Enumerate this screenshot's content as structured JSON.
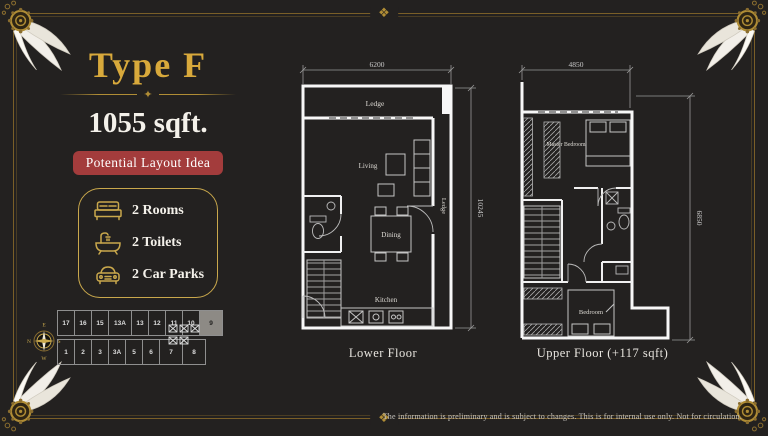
{
  "page": {
    "title": "Type F",
    "size": "1055 sqft.",
    "badge": "Potential Layout Idea"
  },
  "ornaments": {
    "divider_glyph": "✦",
    "frame_glyph": "❖"
  },
  "features": [
    {
      "icon": "bed-icon",
      "label": "2 Rooms"
    },
    {
      "icon": "bathtub-icon",
      "label": "2 Toilets"
    },
    {
      "icon": "car-icon",
      "label": "2 Car Parks"
    }
  ],
  "site_plan": {
    "units_top": [
      "17",
      "16",
      "15",
      "13A",
      "13",
      "12",
      "11",
      "10",
      "9"
    ],
    "units_bottom": [
      "1",
      "2",
      "3",
      "3A",
      "5",
      "6",
      "7",
      "8"
    ],
    "highlighted_unit": "9",
    "compass": {
      "top": "E",
      "right": "S",
      "bottom": "W",
      "left": "N"
    }
  },
  "lower_floor": {
    "label": "Lower Floor",
    "width_dim": "6200",
    "height_dim": "10245",
    "rooms": {
      "ledge_top": "Ledge",
      "living": "Living",
      "dining": "Dining",
      "kitchen": "Kitchen",
      "ledge_right": "Ledge"
    }
  },
  "upper_floor": {
    "label": "Upper Floor (+117 sqft)",
    "width_dim": "4850",
    "height_dim": "6850",
    "rooms": {
      "master_bedroom": "Master Bedroom",
      "bedroom": "Bedroom"
    }
  },
  "footer": {
    "disclaimer": "The information is preliminary and is subject to changes. This is for internal use only. Not for circulation."
  },
  "colors": {
    "background": "#232120",
    "gold": "#c9a84c",
    "gold_dark": "#7a5f28",
    "title_gold": "#d8a93b",
    "badge_red": "#a33c3c",
    "wall_white": "#f7f7f7",
    "highlight_gray": "#8d8a85",
    "text_white": "#f4f1ea"
  }
}
